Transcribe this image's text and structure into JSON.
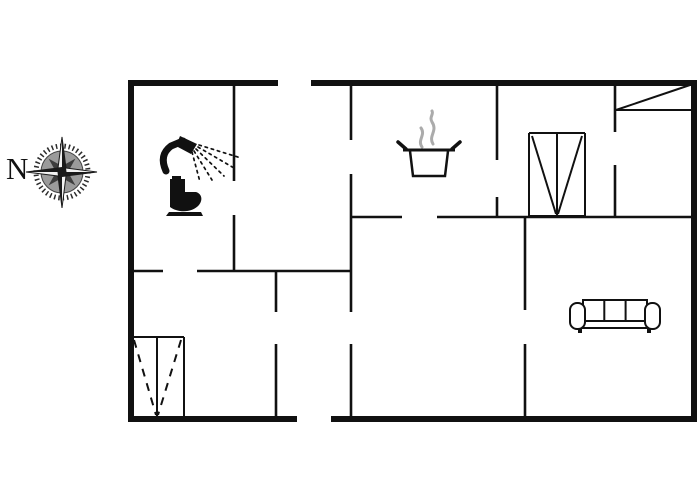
{
  "compass": {
    "label": "N",
    "cx": 62,
    "cy": 172
  },
  "colors": {
    "background": "#ffffff",
    "wall": "#111111",
    "steam": "#ababab",
    "compass_dark": "#2b2b2b",
    "compass_disc": "#9b9b9b"
  },
  "plan": {
    "canvas": {
      "width": 700,
      "height": 500
    },
    "outer_wall_thickness": 6,
    "inner_wall_thickness": 2.6,
    "thin_line_thickness": 2,
    "outer_walls": [
      [
        128,
        83,
        278,
        83
      ],
      [
        311,
        83,
        697,
        83
      ],
      [
        131,
        80,
        131,
        422
      ],
      [
        694,
        80,
        694,
        422
      ],
      [
        128,
        419,
        297,
        419
      ],
      [
        331,
        419,
        697,
        419
      ]
    ],
    "inner_walls": [
      [
        234,
        83,
        234,
        181
      ],
      [
        234,
        215,
        234,
        272
      ],
      [
        128,
        271,
        163,
        271
      ],
      [
        197,
        271,
        352,
        271
      ],
      [
        351,
        83,
        351,
        140
      ],
      [
        351,
        174,
        351,
        312
      ],
      [
        351,
        344,
        351,
        419
      ],
      [
        276,
        270,
        276,
        312
      ],
      [
        276,
        344,
        276,
        419
      ],
      [
        352,
        217,
        402,
        217
      ],
      [
        437,
        217,
        695,
        217
      ],
      [
        497,
        83,
        497,
        160
      ],
      [
        497,
        197,
        497,
        218
      ],
      [
        615,
        83,
        615,
        132
      ],
      [
        615,
        165,
        615,
        218
      ],
      [
        525,
        216,
        525,
        310
      ],
      [
        525,
        344,
        525,
        419
      ]
    ],
    "thin_lines": [
      [
        616,
        110,
        693,
        110
      ],
      [
        616,
        110,
        693,
        84
      ]
    ],
    "wardrobes": [
      {
        "x": 529,
        "y": 133,
        "w": 56,
        "h": 83,
        "divider_x": 557,
        "style": "solid"
      },
      {
        "x": 131,
        "y": 337,
        "w": 53,
        "h": 80,
        "divider_x": 157,
        "style": "dashed"
      }
    ],
    "fixtures": [
      {
        "name": "shower-icon",
        "x": 160,
        "y": 136
      },
      {
        "name": "toilet-icon",
        "x": 165,
        "y": 176
      },
      {
        "name": "stove-pot-icon",
        "x": 398,
        "y": 108
      },
      {
        "name": "sofa-icon",
        "x": 569,
        "y": 297
      }
    ]
  }
}
